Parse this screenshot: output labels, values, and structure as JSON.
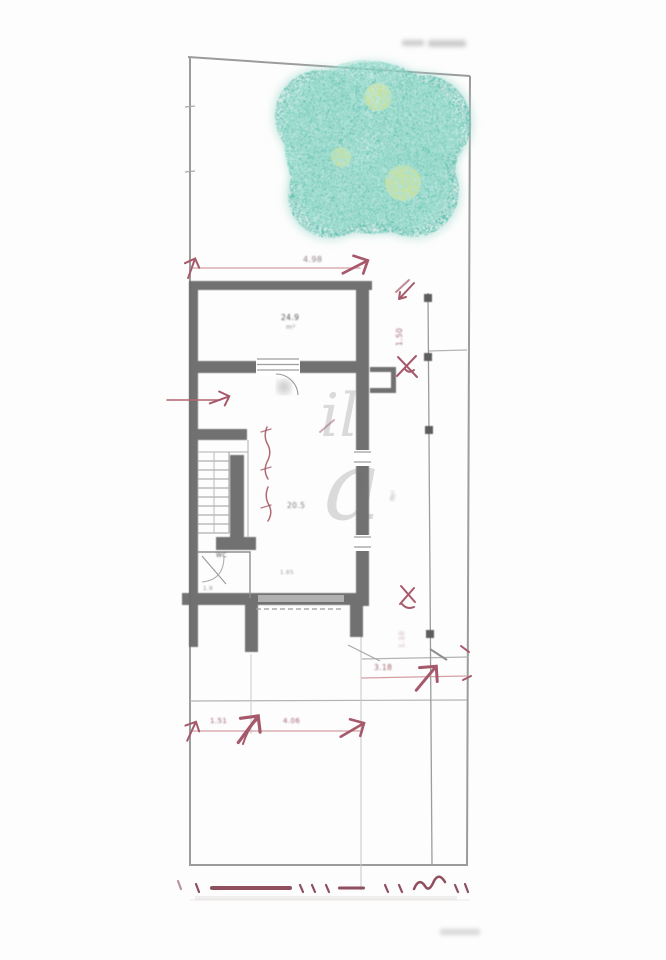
{
  "drawing": {
    "type": "scanned architectural site and floor plan",
    "watermark": {
      "part1": "il",
      "part2": "a"
    },
    "dimensions": {
      "top_width": "4.98",
      "right_upper": "1.50",
      "right_lower": "1.10",
      "front_depth": "3.18",
      "bottom_left": "1.51",
      "bottom_mid": "4.06"
    },
    "room_labels": {
      "upper_room_area": "24.9",
      "upper_room_unit": "m²",
      "main_room_area": "20.5",
      "wc_label": "WC",
      "wc_area": "1.9",
      "hall_note": "1.85",
      "side_note": "m²"
    },
    "illegible_notes": {
      "top_right": "illegible small gray text",
      "bottom_right": "illegible small gray text"
    },
    "colors": {
      "wall": "#6a6a6a",
      "boundary": "#8b8b8b",
      "annotation_red": "#a6596a",
      "dim_line_pink": "#d39fa3",
      "dim_chain_maroon": "#8f4f5f",
      "tree_teal": "#53bcab",
      "tree_light": "#9fe0d2",
      "tree_accent_yellow": "#d6e387"
    }
  }
}
